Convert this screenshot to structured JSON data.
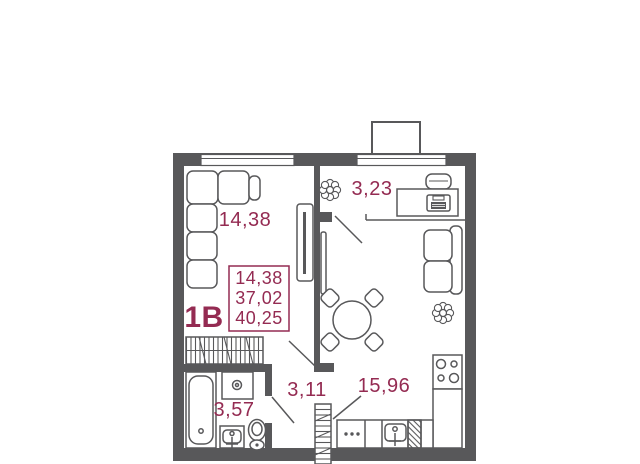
{
  "unit": {
    "type_label": "1В",
    "info_box": {
      "line1": "14,38",
      "line2": "37,02",
      "line3": "40,25"
    }
  },
  "rooms": {
    "living": {
      "area": "14,38"
    },
    "hall": {
      "area": "3,23"
    },
    "corridor": {
      "area": "3,11"
    },
    "kitchen": {
      "area": "15,96"
    },
    "bathroom": {
      "area": "3,57"
    }
  },
  "colors": {
    "accent": "#942b52",
    "walls": "#58585a",
    "background": "#ffffff"
  },
  "icons": {
    "plant": "flower-cluster",
    "sofa": "l-shaped-sofa",
    "tv": "tv-on-stand",
    "table": "round-table-4-chairs",
    "stove": "4-burner-cooktop",
    "sink": "basin-with-faucet",
    "bathtub": "bathtub",
    "washing_machine": "washer-drum",
    "toilet": "toilet",
    "desk": "desk-with-chair-laptop",
    "wardrobe": "hatched-wardrobe",
    "entrance": "hatched-entry-strip"
  }
}
